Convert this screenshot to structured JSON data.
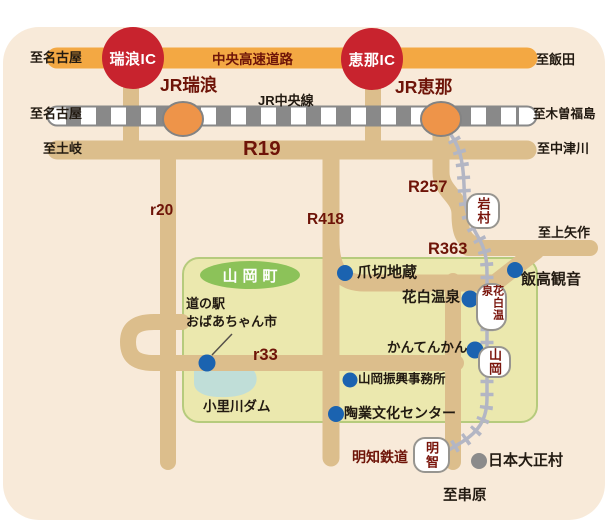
{
  "town_badge": "山岡町",
  "expressway": {
    "name": "中央高速道路",
    "mizunami_ic": "瑞浪IC",
    "ena_ic": "恵那IC",
    "to_left": "至名古屋",
    "to_right": "至飯田"
  },
  "jr_line": {
    "name": "JR中央線",
    "mizunami_station": "JR瑞浪",
    "ena_station": "JR恵那",
    "to_left": "至名古屋",
    "to_right": "至木曽福島"
  },
  "r19": {
    "label": "R19",
    "to_left": "至土岐",
    "to_right": "至中津川"
  },
  "roads": {
    "r20": "r20",
    "r418": "R418",
    "r257": "R257",
    "r363": "R363",
    "r33": "r33",
    "to_kamiyahagi": "至上矢作",
    "to_kushihara": "至串原"
  },
  "akechi_railway": {
    "name": "明知鉄道",
    "stations": {
      "iwamura": "岩村",
      "hanashiro_onsen": "花白温泉",
      "yamaoka": "山岡",
      "akechi": "明智"
    }
  },
  "pois": {
    "michinoeki": {
      "line1": "道の駅",
      "line2": "おばあちゃん市"
    },
    "tsumekiri_jizo": "爪切地蔵",
    "hanashiro_onsen": "花白温泉",
    "iitaka_kannon": "飯高観音",
    "kantenkan": "かんてんかん",
    "yamaoka_shinko_office": "山岡振興事務所",
    "togyo_bunka_center": "陶業文化センター",
    "origawa_dam": "小里川ダム",
    "nihon_taishomura": "日本大正村"
  },
  "colors": {
    "background": "#f8ead9",
    "road_tan": "#dcbe8c",
    "expressway_orange": "#f3a843",
    "ic_red": "#c8232e",
    "jr_station_orange": "#ee9449",
    "jr_rail_gray": "#898989",
    "akechi_rail_gray": "#b3b6c4",
    "poi_blue": "#1b63b0",
    "poi_gray": "#8b8b8b",
    "town_green": "#8cc259",
    "area_fill": "#ebe8ae",
    "area_border": "#b6cb7d",
    "lake_blue": "#c0ded8",
    "label_maroon": "#6e1408"
  }
}
